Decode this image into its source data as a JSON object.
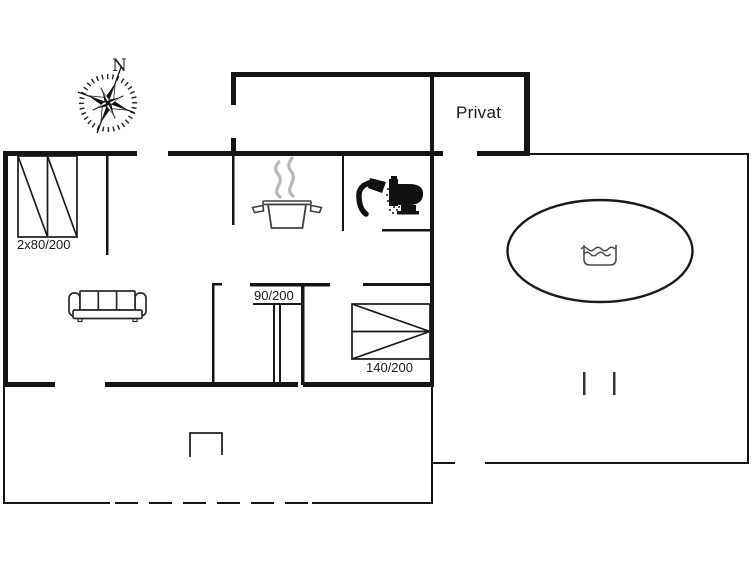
{
  "labels": {
    "compass_north": "N",
    "privat_room": "Privat",
    "bed_twin": "2x80/200",
    "bed_90": "90/200",
    "bed_140": "140/200"
  },
  "icons": {
    "compass": "compass-rose-icon",
    "stove": "cooking-pot-icon",
    "steam": "steam-icon",
    "shower": "shower-icon",
    "toilet": "toilet-icon",
    "sofa": "sofa-icon",
    "whirlpool": "whirlpool-icon",
    "water": "water-icon",
    "grill": "grill-icon",
    "beds": [
      "double-bed-icon",
      "bunk-bed-icon",
      "bed-140-icon"
    ]
  },
  "colors": {
    "wall": "#151515",
    "furniture_outline": "#2a2a2a",
    "steam_gray": "#b9b9b9",
    "water_symbol_gray": "#4a4a4a",
    "background": "#ffffff",
    "text": "#1a1a1a"
  }
}
